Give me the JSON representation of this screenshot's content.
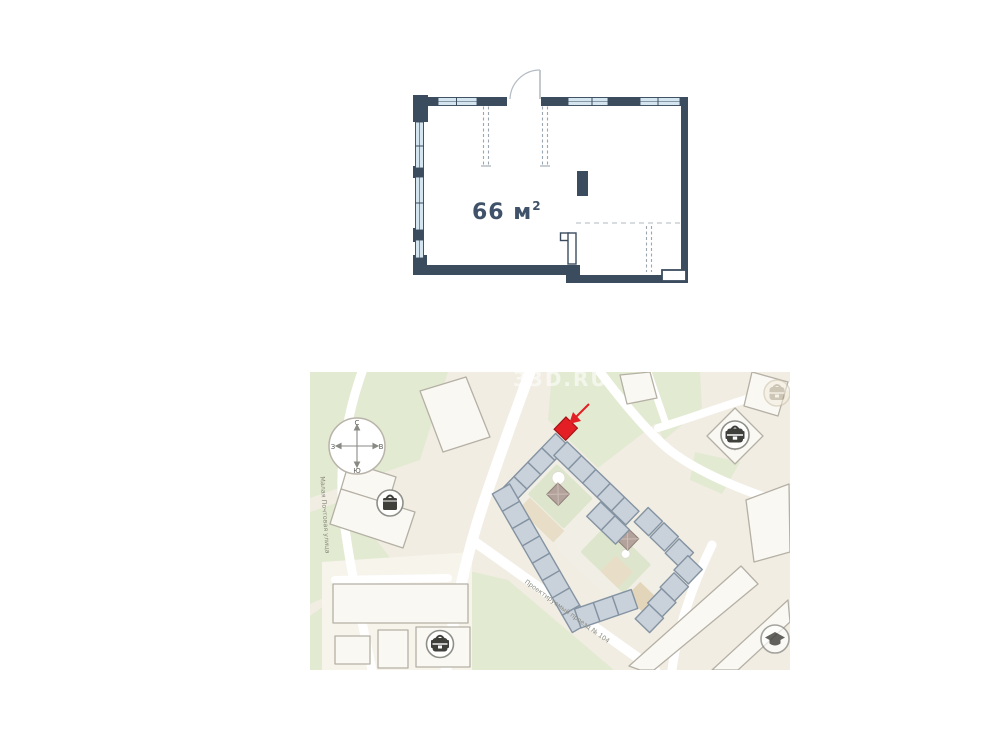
{
  "floor_plan": {
    "area_value": "66 м",
    "area_sup": "2",
    "colors": {
      "wall": "#3b4c5e",
      "window": "#d5e5f0",
      "label": "#3f5269",
      "dash": "#9aa6b0",
      "door_arc": "#b3bcc4"
    }
  },
  "map": {
    "watermark": "33D.RU",
    "compass": {
      "north": "С",
      "south": "Ю",
      "west": "З",
      "east": "В"
    },
    "streets": {
      "small_street": "Малая Почтовая улица",
      "main_street": "Проектируемый проезд № 104"
    },
    "icons": [
      {
        "name": "backpack-icon",
        "position": "top-right-far"
      },
      {
        "name": "backpack-icon",
        "position": "top-right"
      },
      {
        "name": "bag-icon",
        "position": "left-middle"
      },
      {
        "name": "backpack-icon",
        "position": "bottom-left"
      },
      {
        "name": "graduation-cap-icon",
        "position": "bottom-right"
      }
    ],
    "colors": {
      "background": "#f1ede3",
      "green": "#e3ead2",
      "road": "#ffffff",
      "building_fill": "#faf8f3",
      "building_stroke": "#b5b0a5",
      "complex_fill": "#c9d1da",
      "complex_stroke": "#8493a2",
      "courtyard_green": "#dde6cc",
      "highlight": "#e31e24"
    }
  }
}
